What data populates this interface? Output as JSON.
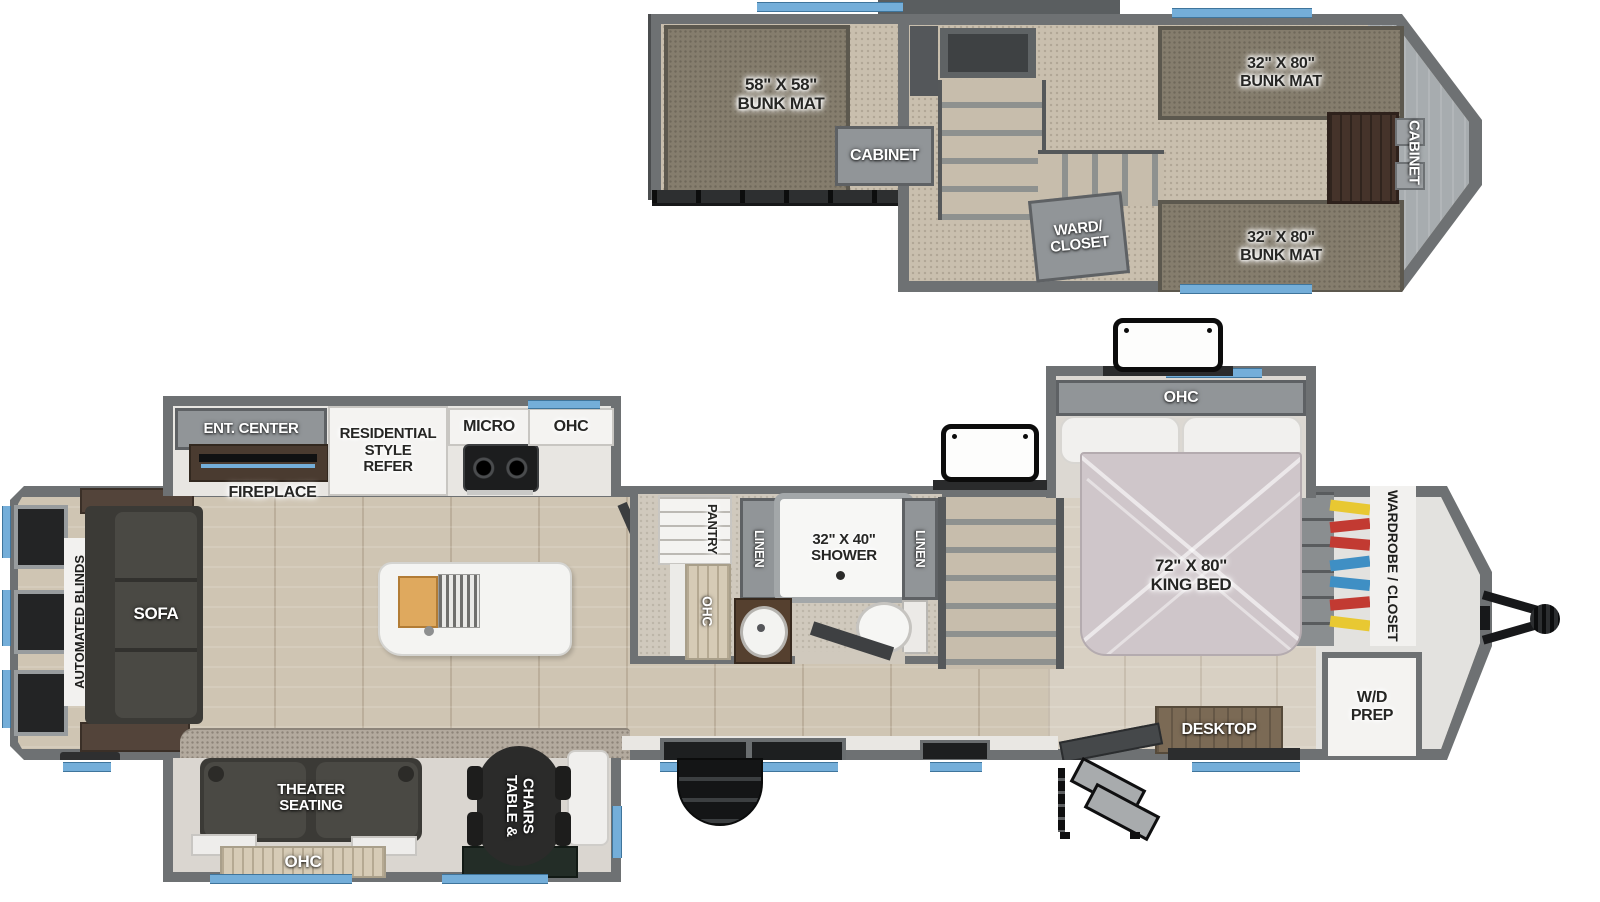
{
  "title": "Fifth Wheel RV Floorplan with Loft",
  "colors": {
    "wall": "#6e7173",
    "wall_dark": "#4b4d4f",
    "accent_blue": "#74aed9",
    "wood": "#cfc5b3",
    "wood_light": "#d8d0c3",
    "carpet": "#c9bfae",
    "mat": "#857d6d",
    "leather": "#4a4944",
    "bed": "#cfc6ca",
    "granite": "#b3aa9e",
    "white": "#f4f3f1",
    "black": "#161718",
    "tan": "#d6cbb6",
    "wood_dark": "#4a3b30",
    "desk": "#7b6a55",
    "cloth_yellow": "#e8c832",
    "cloth_red": "#c23a32",
    "cloth_blue": "#3f8fc4"
  },
  "loft": {
    "bunk58": "58\" X 58\"\nBUNK MAT",
    "cabinet_mid": "CABINET",
    "bunk_top": "32\" X 80\"\nBUNK MAT",
    "bunk_bottom": "32\" X 80\"\nBUNK MAT",
    "ward_closet": "WARD/\nCLOSET",
    "cabinet_front": "CABINET"
  },
  "main": {
    "ent_center": "ENT. CENTER",
    "fireplace": "FIREPLACE",
    "refer": "RESIDENTIAL\nSTYLE\nREFER",
    "micro": "MICRO",
    "ohc_kitchen": "OHC",
    "automated_blinds": "AUTOMATED BLINDS",
    "sofa": "SOFA",
    "pantry": "PANTRY",
    "ohc_pantry": "OHC",
    "linen_left": "LINEN",
    "shower": "32\" X 40\"\nSHOWER",
    "linen_right": "LINEN",
    "ohc_bed": "OHC",
    "king_bed": "72\" X 80\"\nKING BED",
    "wardrobe": "WARDROBE / CLOSET",
    "wd_prep": "W/D\nPREP",
    "desktop": "DESKTOP",
    "theater": "THEATER\nSEATING",
    "table_chairs": "TABLE &\nCHAIRS",
    "ohc_theater": "OHC"
  }
}
